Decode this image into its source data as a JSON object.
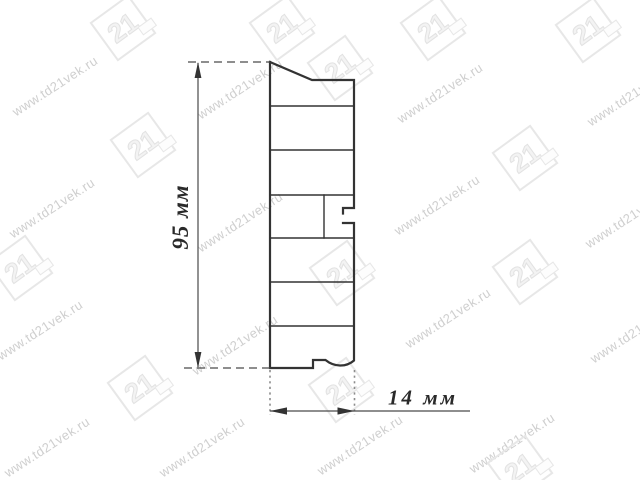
{
  "canvas": {
    "width": 640,
    "height": 480,
    "background": "#ffffff"
  },
  "drawing": {
    "height_label": "95 мм",
    "width_label": "14 мм",
    "line_color": "#333333",
    "dimension_line_color": "#4a4a4a",
    "extension_dot_color": "#8c8c8c",
    "label_color": "#2a2a2a"
  },
  "watermark": {
    "text": "www.td21vek.ru",
    "logo_text": "21",
    "text_color": "#cfcfcf",
    "logo_color": "#e7e7e7",
    "text_positions": [
      {
        "x": 55,
        "y": 86
      },
      {
        "x": 240,
        "y": 89
      },
      {
        "x": 440,
        "y": 93
      },
      {
        "x": 630,
        "y": 96
      },
      {
        "x": 52,
        "y": 208
      },
      {
        "x": 240,
        "y": 222
      },
      {
        "x": 437,
        "y": 205
      },
      {
        "x": 628,
        "y": 218
      },
      {
        "x": 40,
        "y": 330
      },
      {
        "x": 235,
        "y": 345
      },
      {
        "x": 448,
        "y": 318
      },
      {
        "x": 633,
        "y": 333
      },
      {
        "x": 47,
        "y": 447
      },
      {
        "x": 202,
        "y": 447
      },
      {
        "x": 360,
        "y": 445
      },
      {
        "x": 512,
        "y": 443
      }
    ],
    "logo_positions": [
      {
        "x": 123,
        "y": 28
      },
      {
        "x": 282,
        "y": 28
      },
      {
        "x": 433,
        "y": 28
      },
      {
        "x": 588,
        "y": 30
      },
      {
        "x": 340,
        "y": 68
      },
      {
        "x": 143,
        "y": 145
      },
      {
        "x": 525,
        "y": 158
      },
      {
        "x": 20,
        "y": 268
      },
      {
        "x": 342,
        "y": 273
      },
      {
        "x": 525,
        "y": 272
      },
      {
        "x": 140,
        "y": 388
      },
      {
        "x": 341,
        "y": 390
      },
      {
        "x": 520,
        "y": 468
      }
    ]
  }
}
